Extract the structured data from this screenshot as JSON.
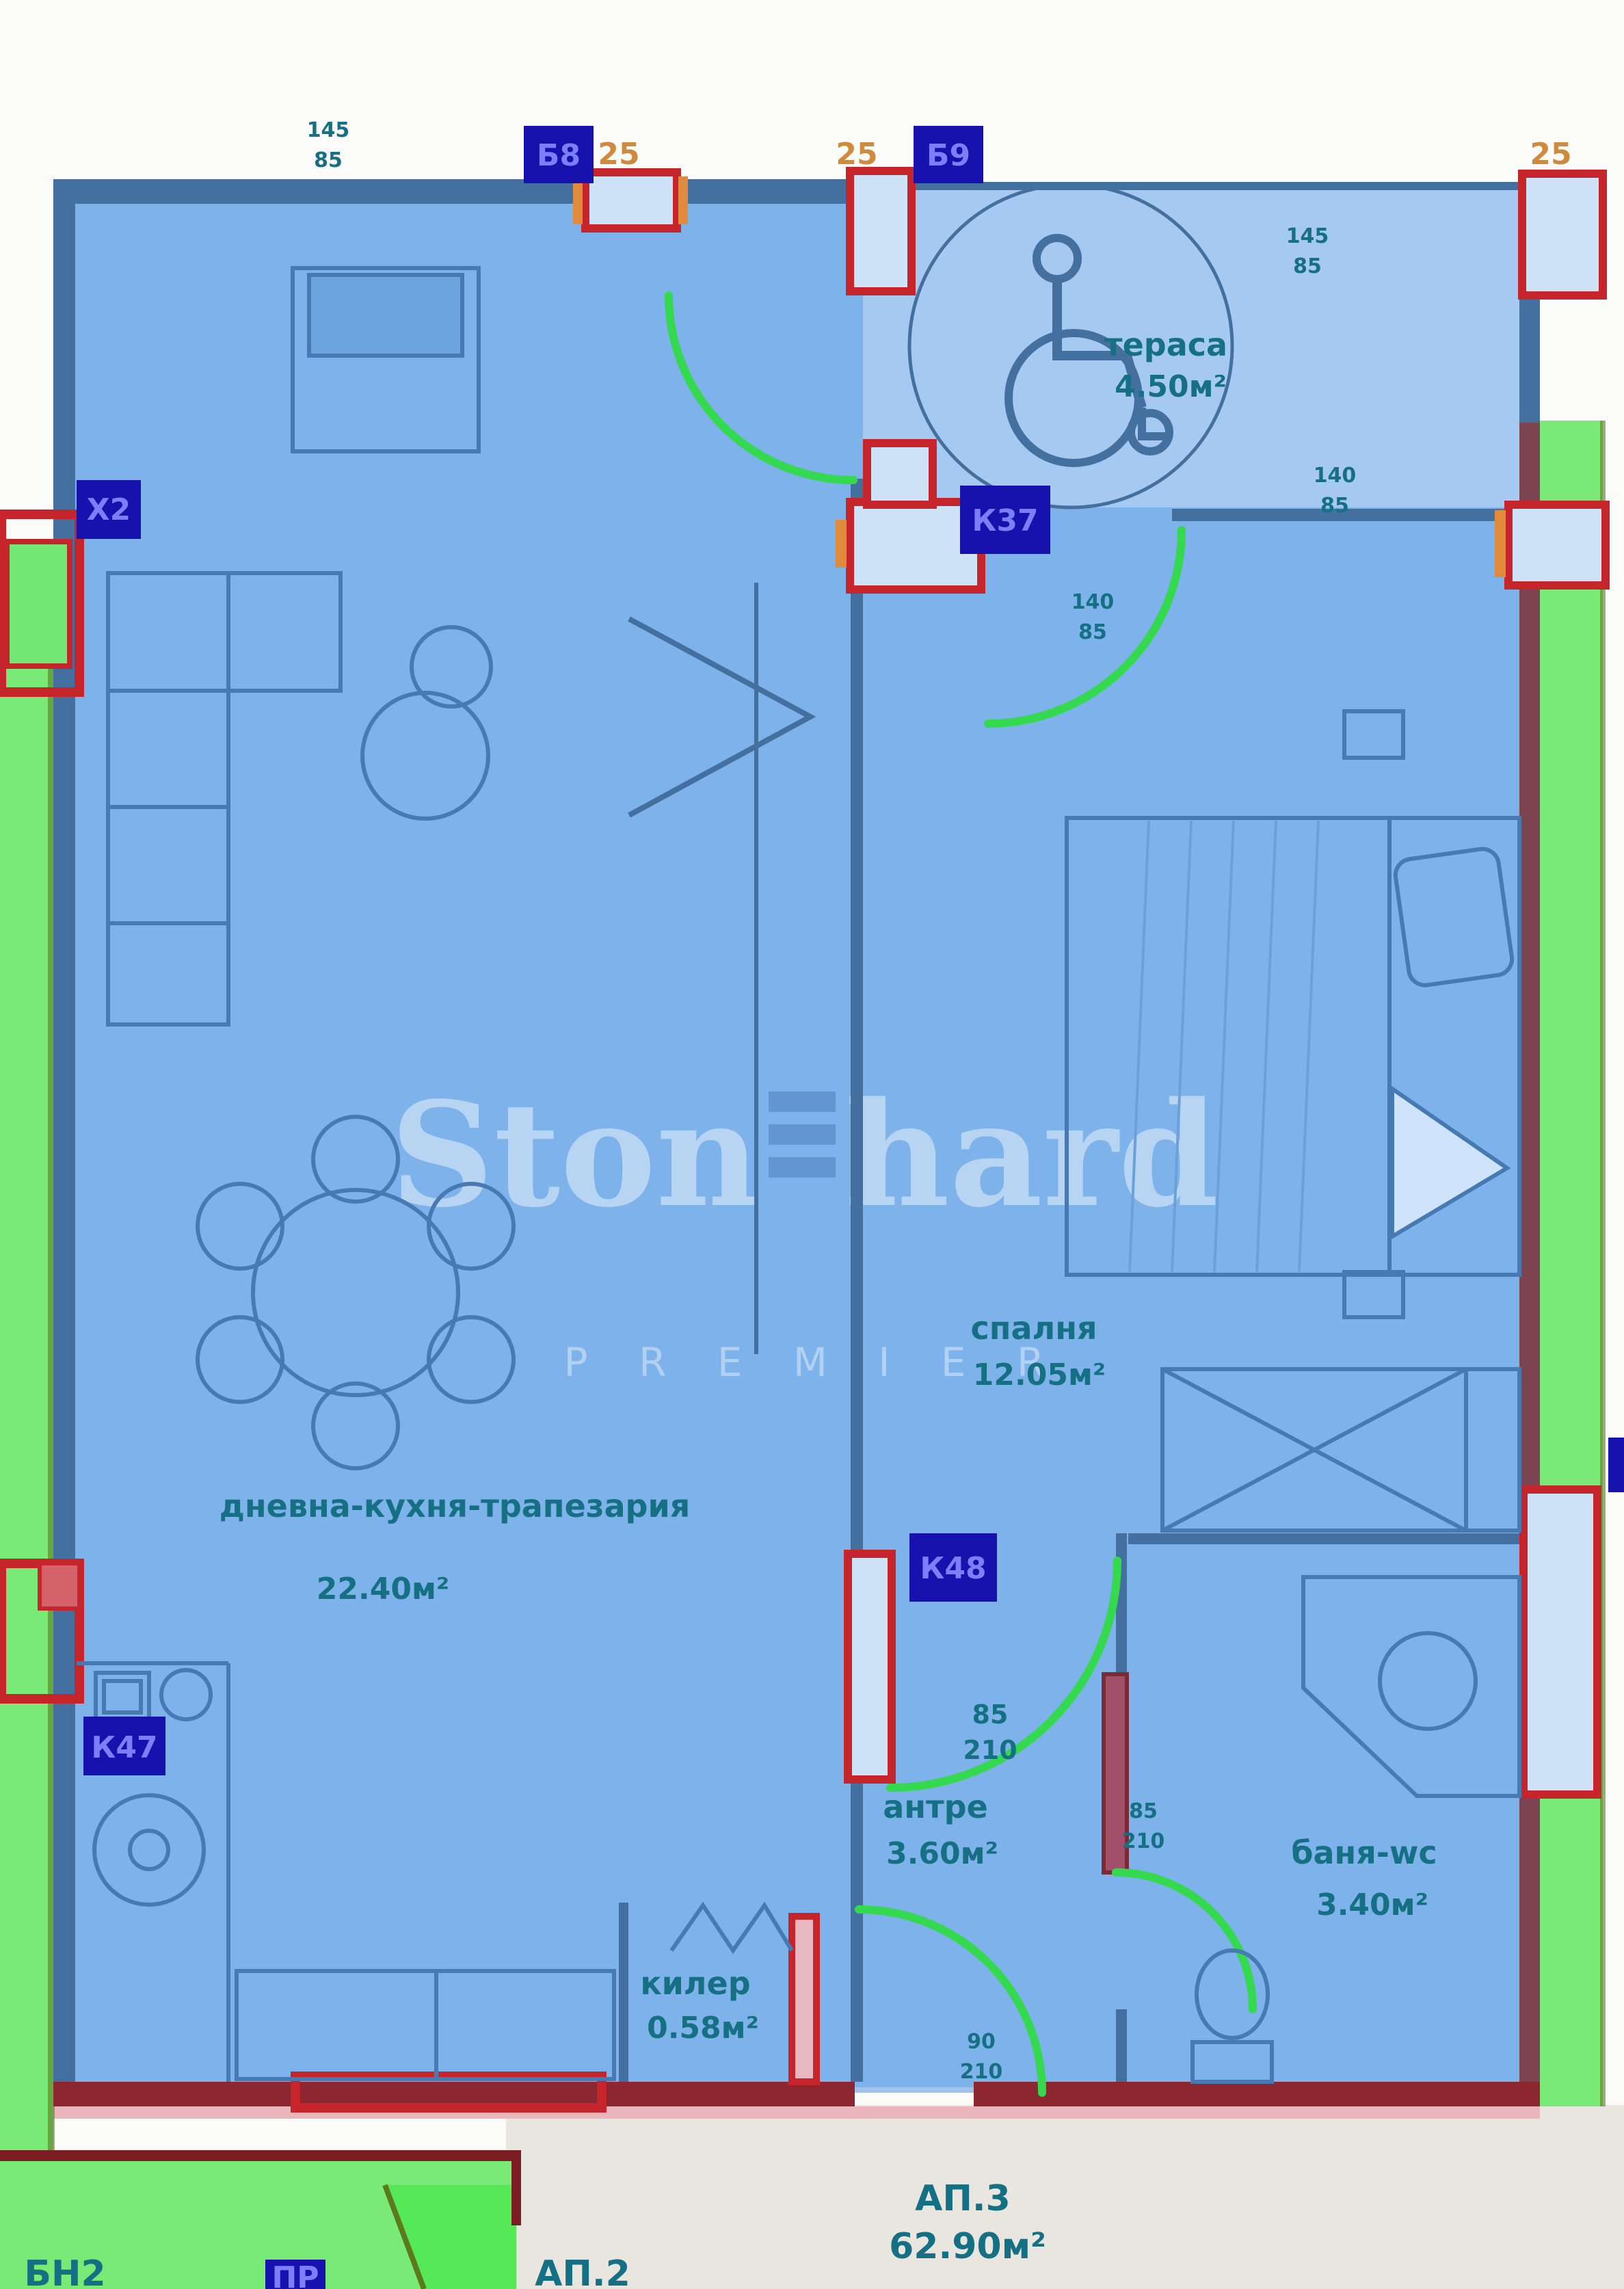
{
  "colors": {
    "apartment_fill": "#7db2ea",
    "terrace_fill": "#a6c9f2",
    "wall_blue": "#44709f",
    "wall_dark_red": "#8c2630",
    "wall_maroon": "#7c4350",
    "frame_red": "#c5252b",
    "door_arc_green": "#35d94f",
    "exterior_green": "#79ea75",
    "exterior_green_bright": "#55e957",
    "exterior_border_olive": "#5b7a1e",
    "label_teal": "#147082",
    "badge_navy": "#1712ad",
    "badge_text": "#7b7ffa",
    "dim_orange": "#d08a3e",
    "outside_white": "#fbfcfa",
    "outside_beige": "#e9e5df",
    "furniture_stroke": "#4779b3",
    "watermark": "#ffffff"
  },
  "watermark": {
    "brand_left": "Ston",
    "brand_right": "hard",
    "subtitle": "P R E M I E R"
  },
  "rooms": {
    "terrace": {
      "name": "тераса",
      "area": "4.50м²"
    },
    "living": {
      "name": "дневна-кухня-трапезария",
      "area": "22.40м²"
    },
    "bedroom": {
      "name": "спалня",
      "area": "12.05м²"
    },
    "hall": {
      "name": "антре",
      "area": "3.60м²"
    },
    "bath": {
      "name": "баня-wc",
      "area": "3.40м²"
    },
    "closet": {
      "name": "килер",
      "area": "0.58м²"
    }
  },
  "codes": {
    "x2": "Х2",
    "k37": "К37",
    "k48": "К48",
    "k47": "К47",
    "top_left": "Б8",
    "top_right": "Б9",
    "bottom": "ПР"
  },
  "dims": {
    "top25_left": "25",
    "top25_mid": "25",
    "top25_right": "25",
    "win_top_left": [
      "145",
      "85"
    ],
    "door_k37": [
      "140",
      "85"
    ],
    "win_right": [
      "140",
      "85"
    ],
    "win_terrace": [
      "145",
      "85"
    ],
    "door_hall": [
      "85",
      "210"
    ],
    "door_k48": [
      "85",
      "210"
    ],
    "door_entrance": [
      "90",
      "210"
    ]
  },
  "apartments": {
    "ap2": "АП.2",
    "ap3": "АП.3",
    "ap3_area": "62.90м²",
    "corner": "БН2"
  }
}
